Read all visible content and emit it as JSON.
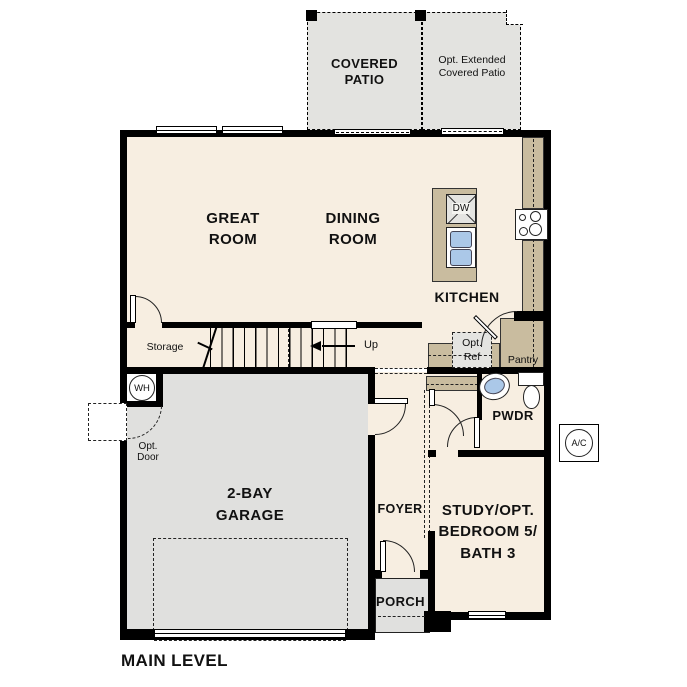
{
  "labels": {
    "covered_patio": "COVERED\nPATIO",
    "opt_extended_patio": "Opt. Extended\nCovered Patio",
    "great_room": "GREAT\nROOM",
    "dining_room": "DINING\nROOM",
    "kitchen": "KITCHEN",
    "storage": "Storage",
    "up": "Up",
    "opt_ref": "Opt.\nRef",
    "pantry": "Pantry",
    "pwdr": "PWDR",
    "foyer": "FOYER",
    "study": "STUDY/OPT.\nBEDROOM 5/\nBATH 3",
    "porch": "PORCH",
    "garage": "2-BAY\nGARAGE",
    "opt_door": "Opt.\nDoor",
    "wh": "WH",
    "ac": "A/C",
    "dw": "DW",
    "main_level": "MAIN LEVEL"
  },
  "colors": {
    "wall": "#000000",
    "floor": "#f7eee1",
    "patio": "#e3e3e0",
    "garage": "#e0e0de",
    "counter": "#c9bc9f",
    "optref": "#e4e4e1",
    "fixture-blue": "#abc8e8"
  }
}
